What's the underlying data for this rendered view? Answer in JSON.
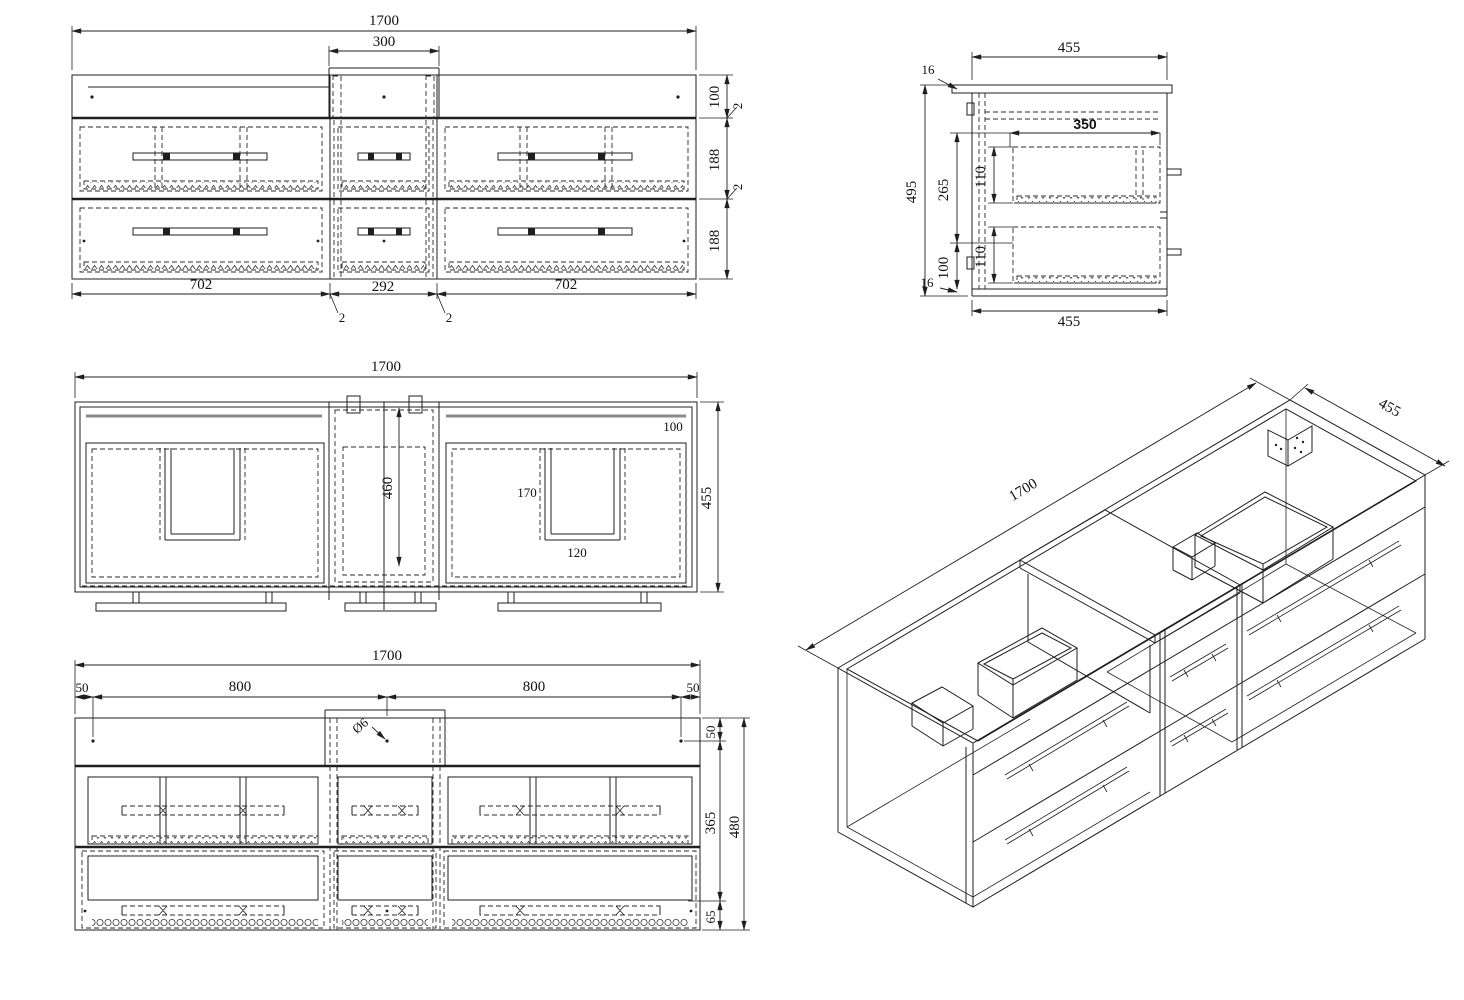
{
  "drawing_title": "wall-hung double vanity cabinet technical drawing",
  "colors": {
    "line": "#1f1f1f",
    "hidden": "#2a2a2a",
    "gray_rail": "#8b8b8b",
    "background": "#ffffff"
  },
  "views": {
    "front": {
      "label": "front elevation",
      "dims": {
        "overall": "1700",
        "recess": "300",
        "top_rail": "100",
        "gap_a": "2",
        "drawer_row_1": "188",
        "gap_b": "2",
        "drawer_row_2": "188",
        "section_left": "702",
        "section_center": "292",
        "section_right": "702",
        "panel_a": "2",
        "panel_b": "2"
      }
    },
    "side": {
      "label": "side section",
      "dims": {
        "depth_top": "455",
        "top_thickness": "16",
        "height": "495",
        "inner_height": "265",
        "bottom_offset": "100",
        "bottom_thickness": "16",
        "drawer_depth": "350",
        "drawer_a": "110",
        "drawer_b": "110",
        "depth_bottom": "455"
      }
    },
    "plan": {
      "label": "plan view",
      "dims": {
        "overall": "1700",
        "back_rail": "100",
        "depth": "455",
        "recess_depth": "460",
        "cutout_length": "170",
        "cutout_width": "120"
      }
    },
    "rear": {
      "label": "rear elevation",
      "dims": {
        "overall": "1700",
        "margin_left": "50",
        "span_left": "800",
        "span_right": "800",
        "margin_right": "50",
        "hole_dia": "Ø6",
        "top": "50",
        "middle": "365",
        "bottom": "65",
        "height": "480"
      }
    },
    "iso": {
      "label": "isometric view",
      "dims": {
        "length": "1700",
        "depth": "455"
      }
    }
  }
}
